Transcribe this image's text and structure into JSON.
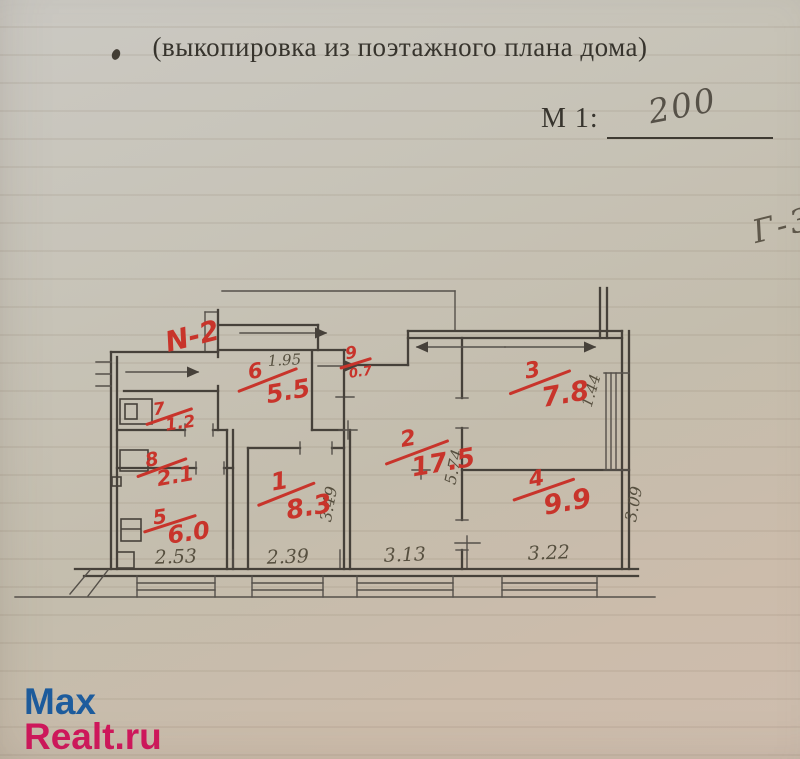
{
  "header": {
    "title": "(выкопировка из поэтажного плана дома)",
    "scale_label": "М 1:",
    "scale_value": "200",
    "corner_note": "Г-3"
  },
  "plan": {
    "apartment_label": "N-2",
    "rooms": [
      {
        "num": "1",
        "area": "8.3"
      },
      {
        "num": "2",
        "area": "17.5"
      },
      {
        "num": "3",
        "area": "7.8"
      },
      {
        "num": "4",
        "area": "9.9"
      },
      {
        "num": "5",
        "area": "6.0"
      },
      {
        "num": "6",
        "area": "5.5"
      },
      {
        "num": "7",
        "area": "1.2"
      },
      {
        "num": "8",
        "area": "2.1"
      },
      {
        "num": "9",
        "area": "0.7"
      }
    ],
    "dimensions": {
      "top_width": "1.95",
      "bottom_widths": [
        "2.53",
        "2.39",
        "3.13",
        "3.22"
      ],
      "room1_depth": "3.49",
      "hall_depth": "5.74",
      "right_window": "1.44",
      "room4_depth": "3.09"
    }
  },
  "watermark": {
    "line1": "Max",
    "line2": "Realt.ru"
  },
  "colors": {
    "red_ink": "#c8342b",
    "drawing_ink": "#46413a",
    "pencil": "#564f3f",
    "paper": "#c6c1b3",
    "watermark_blue": "#1d5c9d",
    "watermark_crimson": "#d0175c"
  }
}
